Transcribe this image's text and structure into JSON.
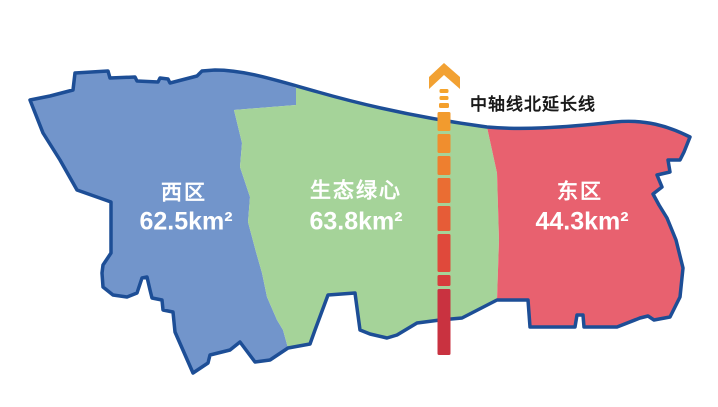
{
  "background": "#FFFFFF",
  "outline_color": "#1D4E96",
  "label_color": "#FFFFFF",
  "axis": {
    "label": "中轴线北延长线",
    "label_color": "#1A1A1A",
    "arrow_color": "#F2A132",
    "center_x": 444,
    "dashes": [
      {
        "y": 89,
        "h": 4,
        "w": 9,
        "color": "#F5A42C"
      },
      {
        "y": 96,
        "h": 4,
        "w": 9,
        "color": "#F5A42C"
      },
      {
        "y": 103,
        "h": 5,
        "w": 10,
        "color": "#F4A02D"
      },
      {
        "y": 112,
        "h": 19,
        "w": 13,
        "color": "#F29B2E"
      },
      {
        "y": 134,
        "h": 19,
        "w": 13,
        "color": "#F08E2E"
      },
      {
        "y": 156,
        "h": 19,
        "w": 13,
        "color": "#EE7F2F"
      },
      {
        "y": 178,
        "h": 25,
        "w": 13,
        "color": "#EA6D33"
      },
      {
        "y": 206,
        "h": 25,
        "w": 13,
        "color": "#E65C37"
      },
      {
        "y": 234,
        "h": 38,
        "w": 13,
        "color": "#E0493B"
      },
      {
        "y": 275,
        "h": 11,
        "w": 13,
        "color": "#D73C3C"
      },
      {
        "y": 289,
        "h": 66,
        "w": 13,
        "color": "#C93240"
      }
    ]
  },
  "regions": [
    {
      "id": "west",
      "name": "西区",
      "area": "62.5km²",
      "fill": "#7295CB"
    },
    {
      "id": "green_heart",
      "name": "生态绿心",
      "area": "63.8km²",
      "fill": "#A5D399"
    },
    {
      "id": "east",
      "name": "东区",
      "area": "44.3km²",
      "fill": "#E8616F"
    }
  ]
}
